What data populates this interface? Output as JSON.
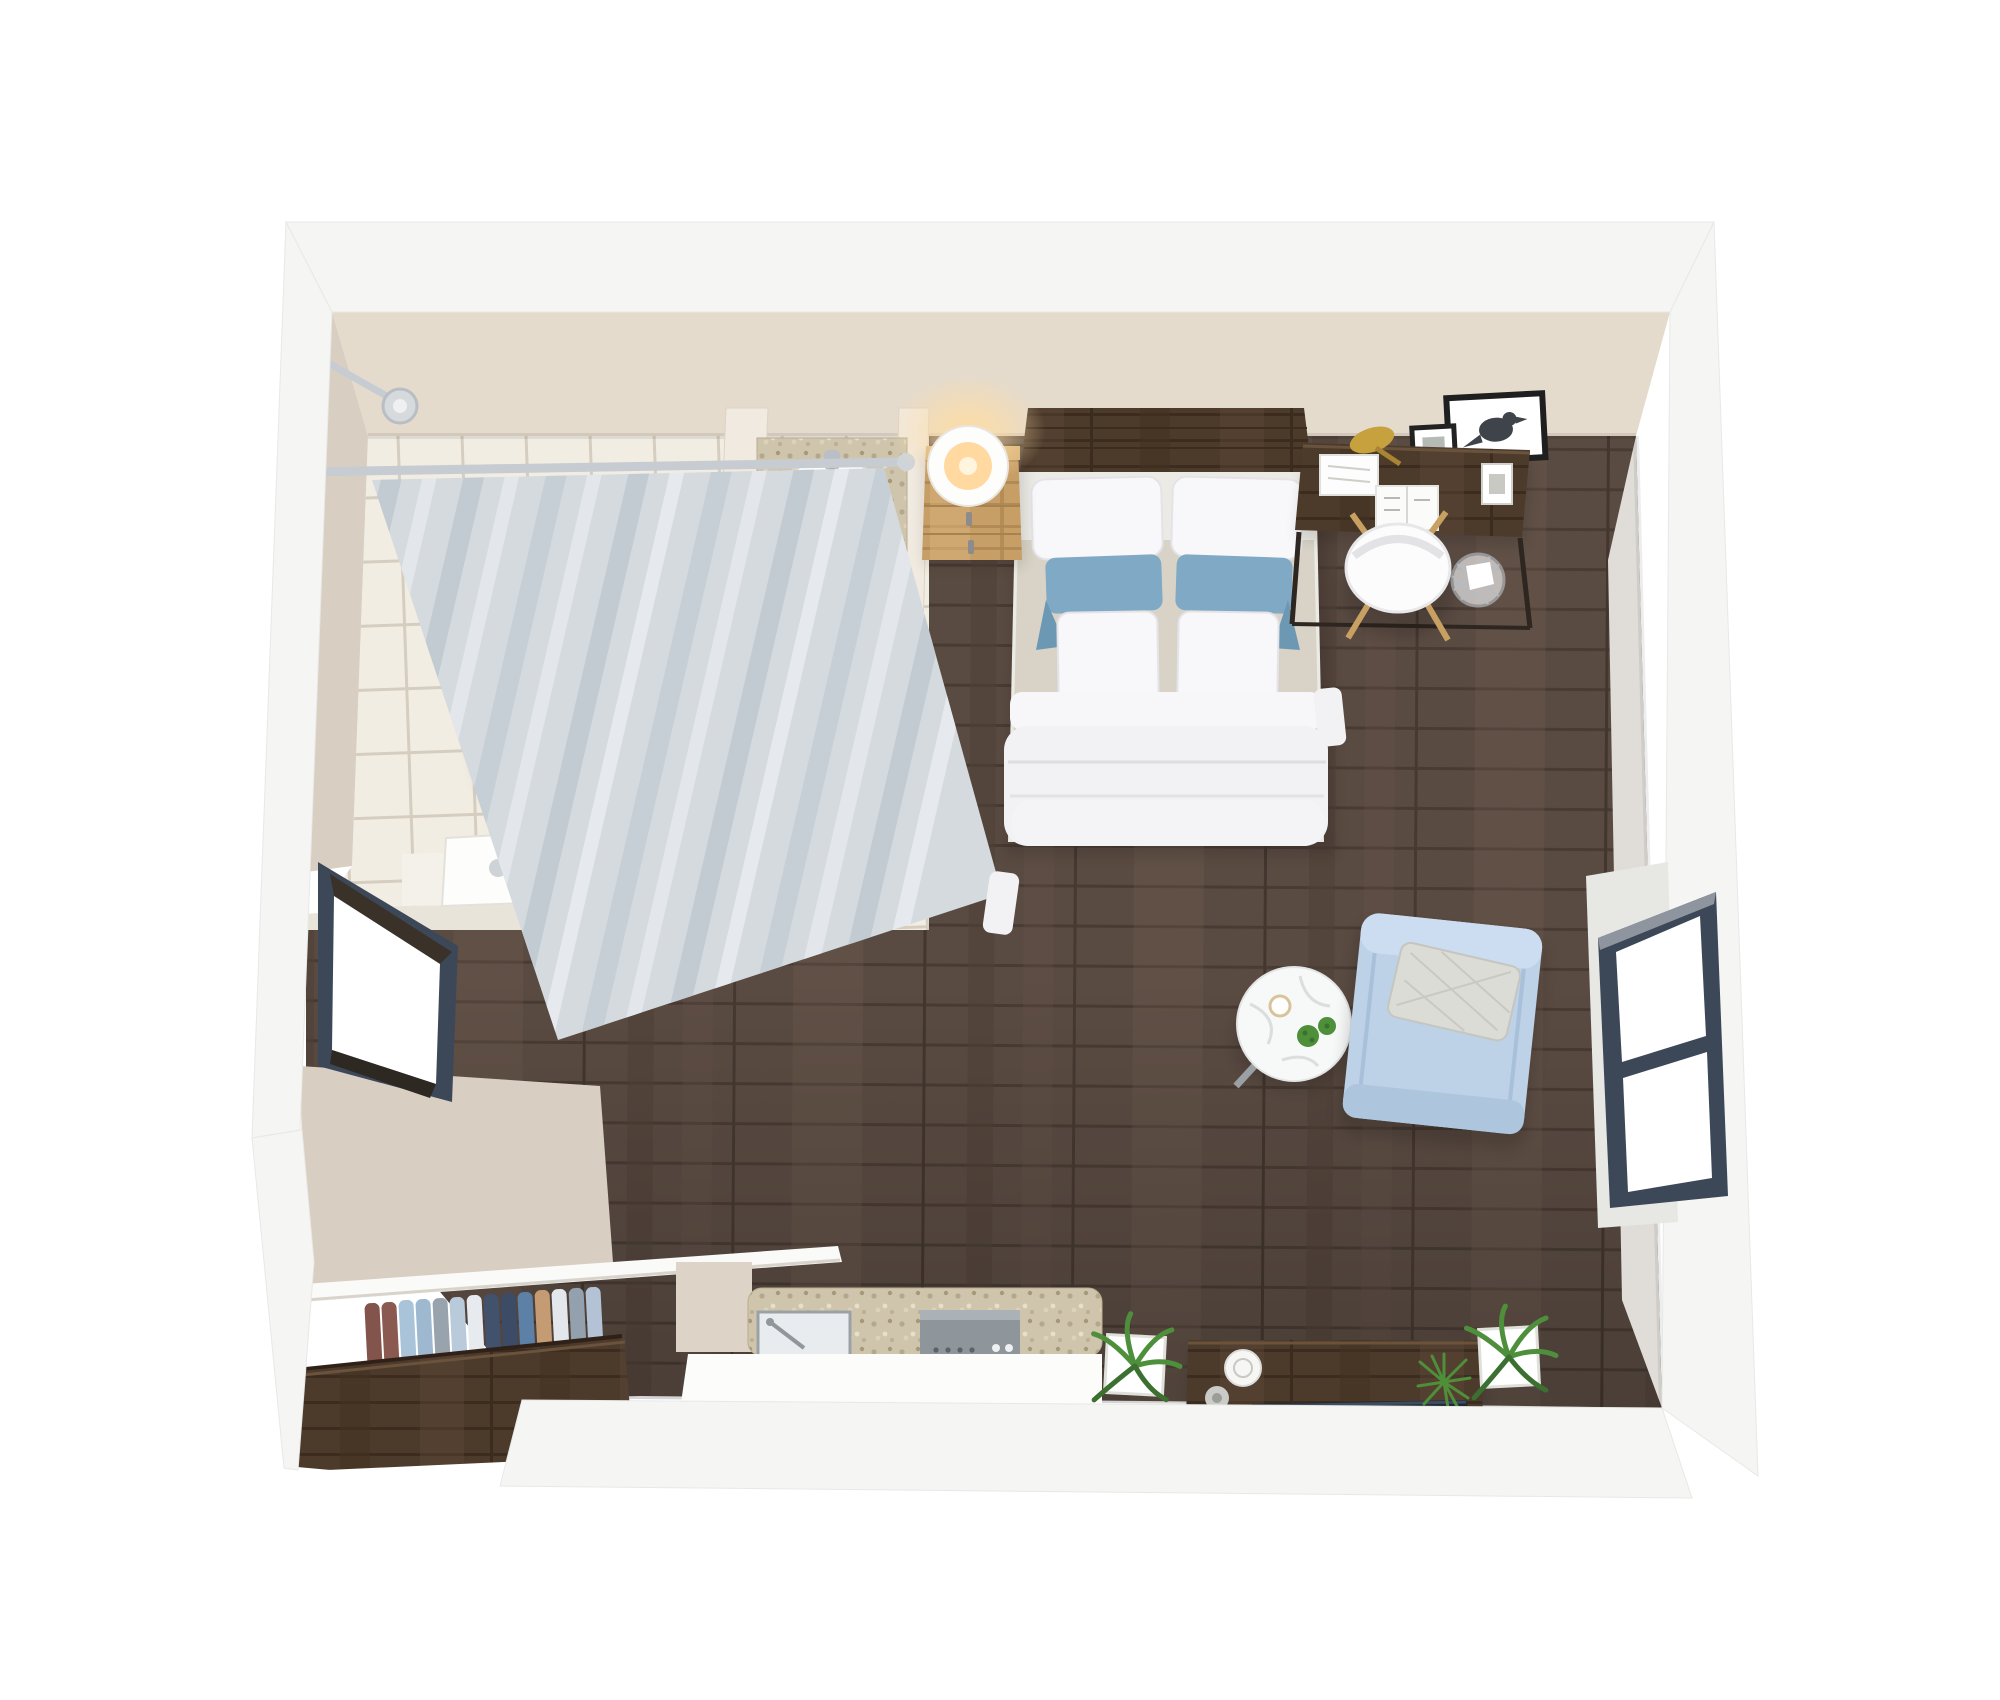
{
  "meta": {
    "scene": "3d-floor-plan-studio-apartment-top-view",
    "style": "photoreal render, no text labels"
  },
  "palette": {
    "background": "#ffffff",
    "wall_outer": "#f5f5f3",
    "wall_inner": "#e4dbcd",
    "wall_inner_dark": "#d8cec1",
    "wall_reveal": "#e7e7e4",
    "tile_floor": "#f2ede3",
    "tile_grout": "#d5cdbf",
    "wood_floor": "#5a4b42",
    "wood_plank_line": "#483b33",
    "walnut_dark": "#4c3a2b",
    "oak_light": "#c79e66",
    "nightstand_top": "#d8b278",
    "porcelain": "#fdfdfc",
    "curtain": "#d4dade",
    "curtain_fold": "#c2cbd2",
    "chrome": "#c6ccd2",
    "mosaic_counter": "#cfc5ad",
    "bedding_white": "#f2f2f5",
    "sheet_beige": "#d8d3c6",
    "pillow_white": "#f8f8fa",
    "pillow_blue": "#7fa9c4",
    "armchair_blue": "#bdd1e7",
    "armchair_pillow": "#dcdcd6",
    "window_frame": "#3c4858",
    "window_glass": "#ffffff",
    "door_white": "#fbfbfa",
    "shelf_white": "#fafaf8",
    "counter_white": "#fcfcfb",
    "tv_screen": "#1f2833",
    "gold_lamp": "#c7a13e",
    "plant_green": "#4e8f3a",
    "marble_white": "#f7f8f8",
    "speaker_white": "#f6f6f4",
    "lamp_glow": "#ffd9a0"
  },
  "rooms": {
    "bathroom": {
      "fixtures": [
        "shower",
        "shower-curtain",
        "curtain-rod",
        "shower-head",
        "oak-bench",
        "vanity-mosaic-counter",
        "vanity-sink",
        "toilet",
        "bathroom-door",
        "tile-floor",
        "partition-walls"
      ]
    },
    "main_room": {
      "furniture": [
        "double-bed",
        "headboard",
        "nightstand",
        "table-lamp",
        "desk",
        "desk-lamp",
        "desk-chair",
        "picture-frames",
        "trash-can",
        "armchair",
        "coffee-table",
        "wardrobe",
        "kitchenette",
        "kitchen-sink",
        "cooktop",
        "tv-console",
        "tv",
        "speaker",
        "potted-plants"
      ]
    }
  },
  "bed": {
    "back_pillow_count": 2,
    "accent_pillow_count": 2,
    "front_pillow_count": 2,
    "accent_color": "#7fa9c4"
  },
  "closet": {
    "clothes_count": 14,
    "clothes_colors": [
      "#82544c",
      "#8a5a50",
      "#a9c3d9",
      "#9db8cf",
      "#99a3ad",
      "#b9cadb",
      "#e7eaee",
      "#42526c",
      "#3c4c66",
      "#5d80a6",
      "#c49b72",
      "#e3e6ea",
      "#93a0ad",
      "#b3c2d4"
    ]
  },
  "windows": {
    "count": 2,
    "frame_color": "#3c4858",
    "panes_right_window": 2,
    "panes_left_window": 1
  },
  "plants": {
    "potted_count": 4,
    "table_succulent_count": 2
  }
}
